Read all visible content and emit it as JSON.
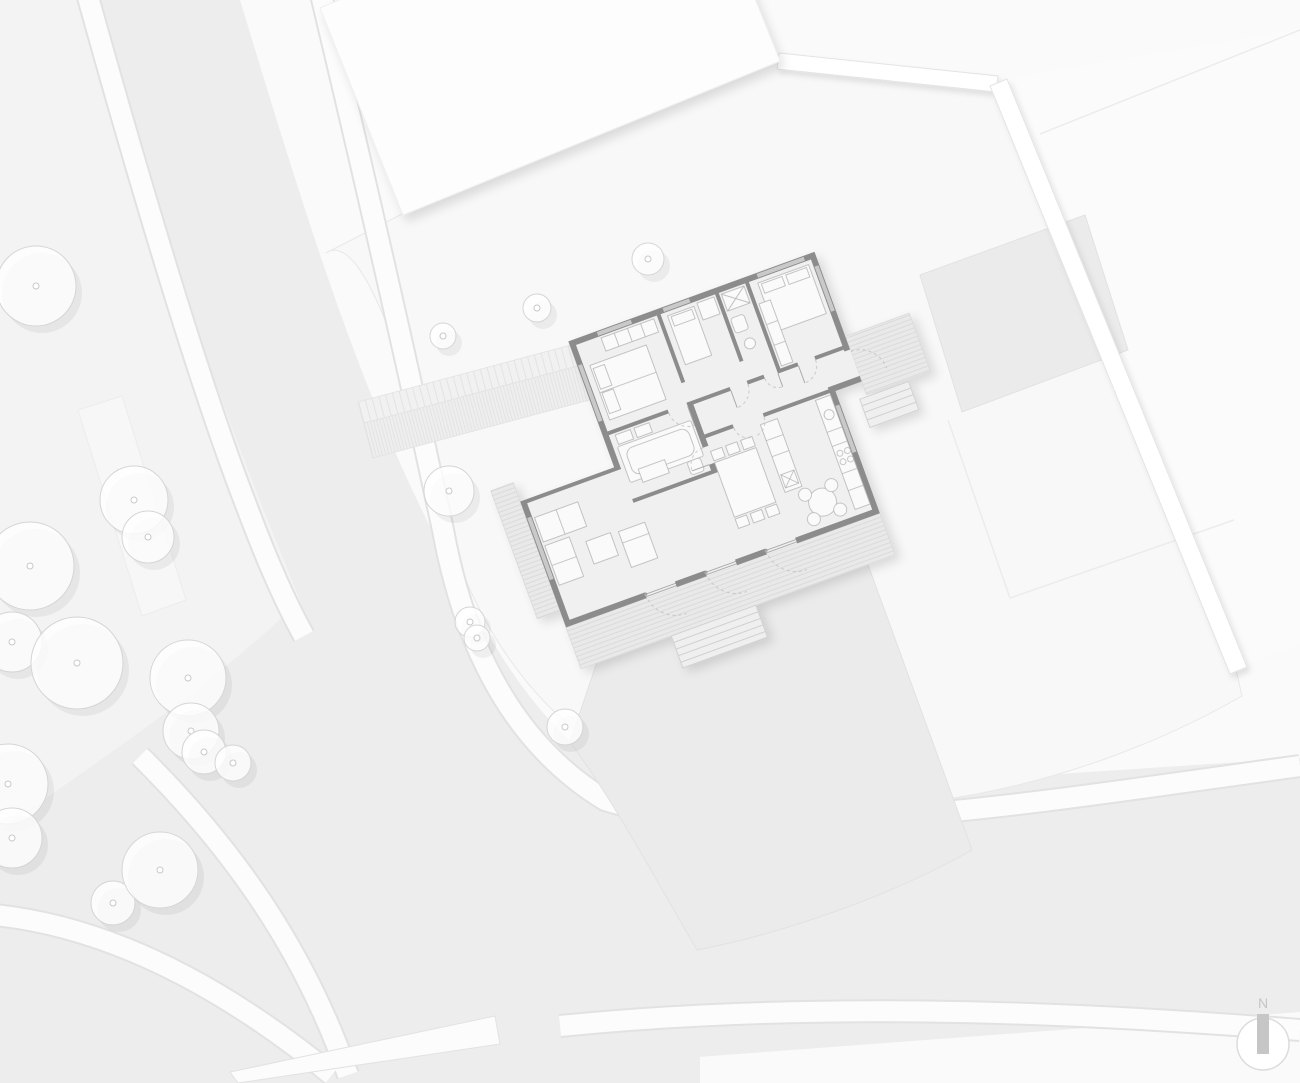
{
  "scene": {
    "type": "architectural-site-plan",
    "description": "Ground-floor site plan of a single-family house with garden plot, street and trees"
  },
  "palette": {
    "bg": "#fafafa",
    "verge": "#f3f3f3",
    "road": "#ededed",
    "walk": "#fcfcfc",
    "walk_edge": "#e2e2e2",
    "plot": "#f8f8f8",
    "patch": "#ebebeb",
    "building": "#fdfdfd",
    "wall": "#8c8c8c",
    "floor": "#f0f0f0",
    "furniture": "#fafafa",
    "furniture_edge": "#b5b5b5",
    "deck": "#e9e9e9",
    "deck_line": "#d4d4d4",
    "window": "#c9c9c9",
    "door_arc": "#c2c2c2",
    "tree_outline": "#d5d5d5",
    "compass": "#c6c6c6"
  },
  "compass": {
    "label": "N"
  },
  "trees": {
    "street": [
      {
        "x": 36,
        "y": 286,
        "r": 40
      },
      {
        "x": 134,
        "y": 500,
        "r": 34
      },
      {
        "x": 148,
        "y": 537,
        "r": 26
      },
      {
        "x": 30,
        "y": 566,
        "r": 44
      },
      {
        "x": 12,
        "y": 642,
        "r": 30
      },
      {
        "x": 77,
        "y": 663,
        "r": 46
      },
      {
        "x": 188,
        "y": 678,
        "r": 38
      },
      {
        "x": 191,
        "y": 731,
        "r": 28
      },
      {
        "x": 8,
        "y": 784,
        "r": 40
      },
      {
        "x": 12,
        "y": 838,
        "r": 30
      },
      {
        "x": 113,
        "y": 903,
        "r": 22
      },
      {
        "x": 160,
        "y": 870,
        "r": 38
      },
      {
        "x": 204,
        "y": 752,
        "r": 22
      },
      {
        "x": 233,
        "y": 763,
        "r": 18
      }
    ],
    "garden": [
      {
        "x": 648,
        "y": 259,
        "r": 16
      },
      {
        "x": 537,
        "y": 308,
        "r": 14
      },
      {
        "x": 443,
        "y": 336,
        "r": 13
      },
      {
        "x": 449,
        "y": 491,
        "r": 25
      },
      {
        "x": 470,
        "y": 622,
        "r": 15
      },
      {
        "x": 477,
        "y": 638,
        "r": 13
      },
      {
        "x": 565,
        "y": 727,
        "r": 18
      }
    ]
  }
}
